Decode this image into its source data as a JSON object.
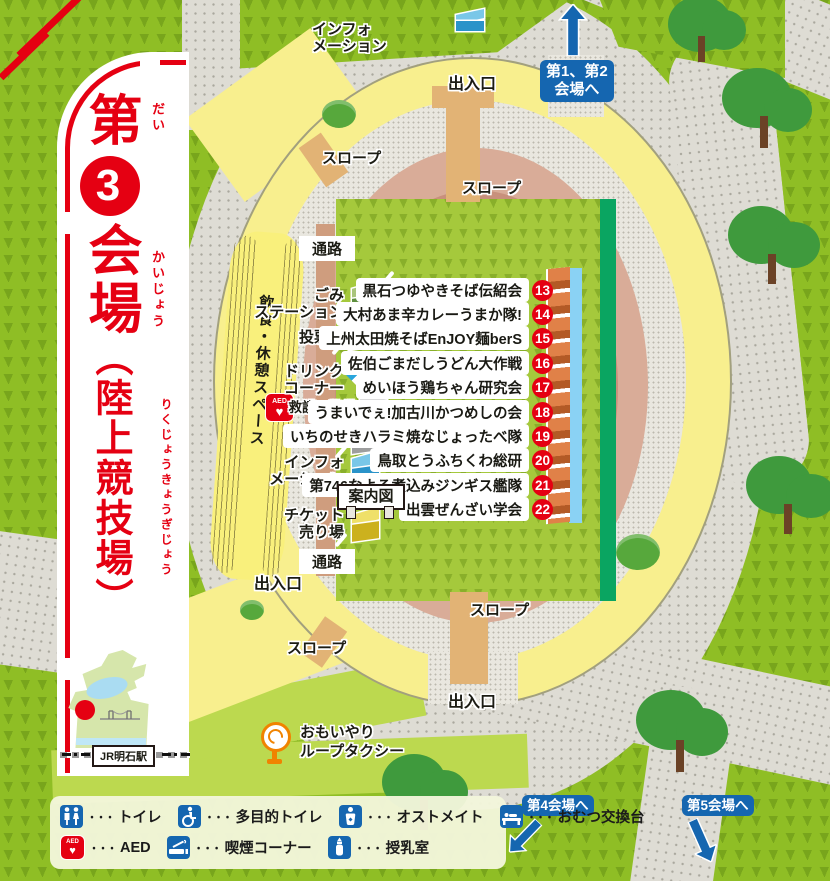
{
  "title": {
    "prefix": "第",
    "number": "3",
    "middle": "会場",
    "paren": "（陸上競技場）",
    "furigana": {
      "dai": "だい",
      "kaijou": "かいじょう",
      "rikujou": "りくじょうきょうぎじょう"
    }
  },
  "nav": {
    "to_venues_1_2": {
      "line1": "第1、第2",
      "line2": "会場へ"
    },
    "to_venue_4": "第4会場へ",
    "to_venue_5": "第5会場へ"
  },
  "map_labels": {
    "entrance": "出入口",
    "slope": "スロープ",
    "passage": "通路",
    "guide_sign": "案内図",
    "stand": "飲食・休憩スペース",
    "info_line1": "インフォ",
    "info_line2": "メーション",
    "taxi_line1": "おもいやり",
    "taxi_line2": "ループタクシー",
    "station": "JR明石駅"
  },
  "facilities": [
    {
      "line1": "ごみ",
      "line2": "ステーション",
      "tent": "green"
    },
    {
      "line1": "投票所",
      "line2": "",
      "tent": "red"
    },
    {
      "line1": "ドリンク",
      "line2": "コーナー",
      "tent": "canopy"
    },
    {
      "line1": "救護・警備",
      "line2": "",
      "tent": "gray"
    },
    {
      "line1": "本部",
      "line2": "",
      "tent": "gray"
    },
    {
      "line1": "インフォ",
      "line2": "メーション",
      "tent": "blue"
    },
    {
      "line1": "チケット",
      "line2": "売り場",
      "tent": "yellow"
    }
  ],
  "booths": [
    {
      "no": "13",
      "name": "黒石つゆやきそば伝紹会"
    },
    {
      "no": "14",
      "name": "大村あま辛カレーうまか隊!"
    },
    {
      "no": "15",
      "name": "上州太田焼そばEnJOY麺berS"
    },
    {
      "no": "16",
      "name": "佐伯ごまだしうどん大作戦"
    },
    {
      "no": "17",
      "name": "めいほう鶏ちゃん研究会"
    },
    {
      "no": "18",
      "name": "うまいでぇ!加古川かつめしの会"
    },
    {
      "no": "19",
      "name": "いちのせきハラミ焼なじょったべ隊"
    },
    {
      "no": "20",
      "name": "鳥取とうふちくわ総研"
    },
    {
      "no": "21",
      "name": "第746なよろ煮込みジンギス艦隊"
    },
    {
      "no": "22",
      "name": "出雲ぜんざい学会"
    }
  ],
  "legend": {
    "dots": "・・・",
    "items": [
      {
        "icon": "toilet-icon",
        "label": "トイレ"
      },
      {
        "icon": "accessible-toilet-icon",
        "label": "多目的トイレ"
      },
      {
        "icon": "ostomate-icon",
        "label": "オストメイト"
      },
      {
        "icon": "diaper-changing-icon",
        "label": "おむつ交換台"
      },
      {
        "icon": "aed-icon",
        "label": "AED"
      },
      {
        "icon": "smoking-area-icon",
        "label": "喫煙コーナー"
      },
      {
        "icon": "nursing-room-icon",
        "label": "授乳室"
      }
    ]
  },
  "aed_icon_text": "AED",
  "colors": {
    "accent_red": "#e50012",
    "nav_blue": "#1566b0",
    "field_green": "#a5c93c",
    "track_pink": "#c8907c",
    "stand_yellow": "#f8ef8e"
  }
}
